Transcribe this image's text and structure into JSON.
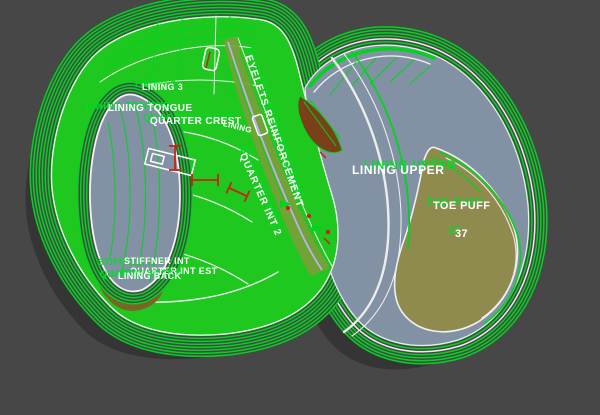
{
  "labels": {
    "lining3": "LINING 3",
    "lining_tongue": "LINING TONGUE",
    "quarter_crest": "QUARTER CREST",
    "lining_small": "LINING",
    "eyelets_reinforcement": "EYELETS REINFORCEMENT",
    "quarter_int_2": "QUARTER INT 2",
    "lining_upper": "LINING UPPER",
    "toe_puff": "TOE PUFF",
    "toe_puff_size": "37",
    "stiffner_int": "STIFFNER INT",
    "quarter_int_est": "QUARTER INT EST",
    "lining_back": "LINING BACK"
  },
  "colors": {
    "background": "#474747",
    "outline_green": "#00d41e",
    "fill_green": "#1ec81e",
    "fill_bluegray": "#8292a4",
    "fill_khaki": "#8f8a4e",
    "fill_brown": "#7a4018",
    "fill_olive": "#7aa03a",
    "accent_lavender": "#b8b2ee",
    "marker_red": "#cc2010",
    "text_white": "#ffffff",
    "text_ghost_green": "#00dc28"
  },
  "pieces": [
    {
      "name": "lining-3"
    },
    {
      "name": "lining-tongue"
    },
    {
      "name": "quarter-crest"
    },
    {
      "name": "eyelets-reinforcement"
    },
    {
      "name": "quarter-int-2"
    },
    {
      "name": "lining-upper"
    },
    {
      "name": "toe-puff",
      "size": "37"
    },
    {
      "name": "stiffner-int"
    },
    {
      "name": "quarter-int-est"
    },
    {
      "name": "lining-back"
    }
  ]
}
